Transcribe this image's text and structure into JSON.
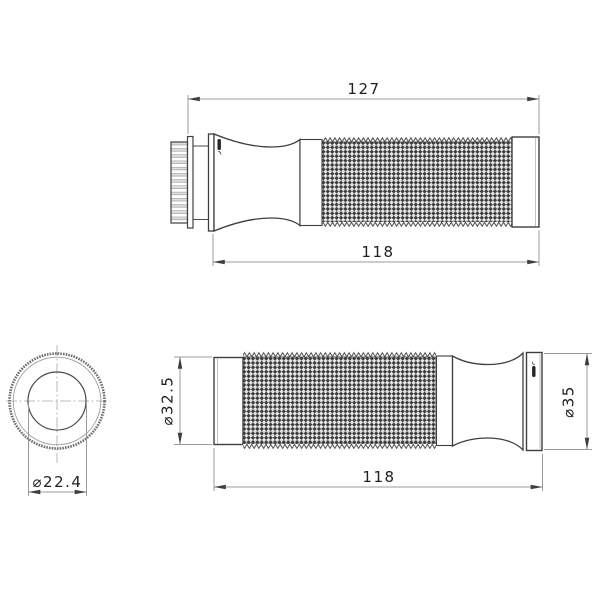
{
  "colors": {
    "background": "#ffffff",
    "outline": "#3f3f3f",
    "dimension_lines": "#9b9b9b",
    "dimension_text": "#1f1f1f",
    "knurl_dark": "#3a3a3a"
  },
  "views": {
    "side_view_throttle": {
      "overall_length": "127",
      "grip_length": "118",
      "logo": "rizoma-logo"
    },
    "end_view": {
      "inner_diameter": "⌀22.4"
    },
    "side_view_outer": {
      "left_diameter": "⌀32.5",
      "right_diameter": "⌀35",
      "grip_length": "118",
      "logo": "rizoma-logo"
    }
  }
}
